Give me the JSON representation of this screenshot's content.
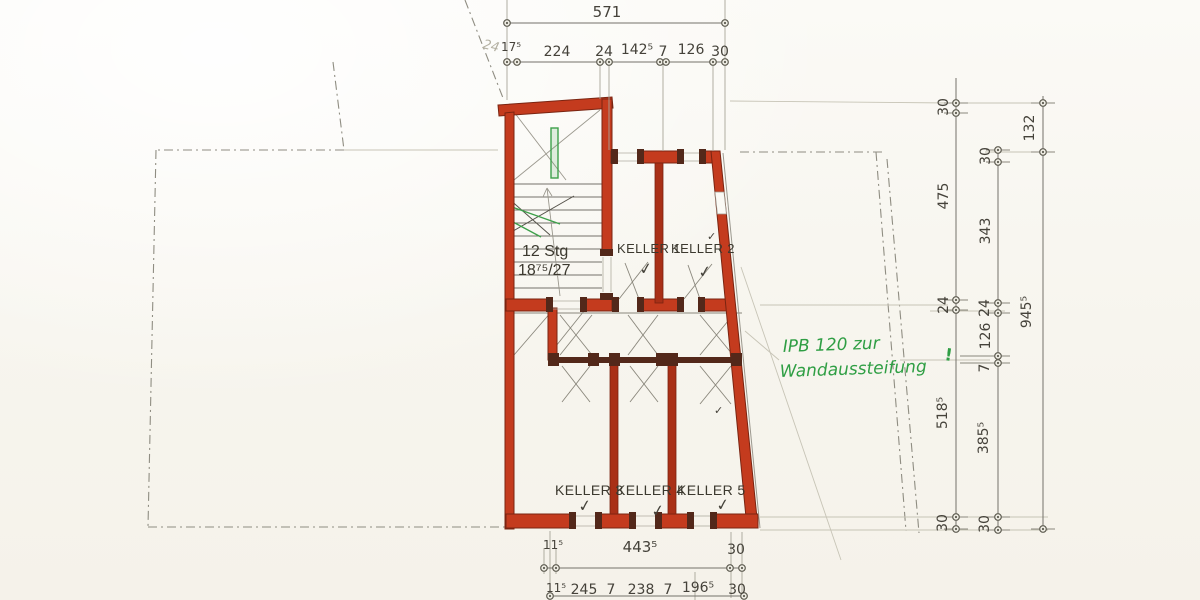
{
  "document": {
    "kind": "scanned hand-drawn basement floor plan (Kellergeschoss)",
    "language": "German"
  },
  "rooms": {
    "stair": {
      "line1": "12 Stg",
      "line2": "18⁷⁵/27"
    },
    "k1": "KELLER 1",
    "k2": "KELLER 2",
    "k3": "KELLER 3",
    "k4": "KELLER 4",
    "k5": "KELLER 5"
  },
  "note": {
    "line1": "IPB 120 zur",
    "line2": "Wandaussteifung",
    "mark": "!"
  },
  "annotations": {
    "corner": "24"
  },
  "symbols": {
    "check": "✓"
  },
  "dims": {
    "top_overall": "571",
    "top_chain": [
      "17⁵",
      "224",
      "24",
      "142⁵",
      "7",
      "126",
      "30"
    ],
    "right_outer": [
      "30",
      "475",
      "24",
      "518⁵",
      "30"
    ],
    "right_inner": [
      "30",
      "343",
      "24",
      "126",
      "7",
      "385⁵",
      "30"
    ],
    "right_far": [
      "132",
      "945⁵"
    ],
    "bottom_row1": [
      "11⁵",
      "443⁵",
      "30"
    ],
    "bottom_row2": [
      "11⁵",
      "245",
      "7",
      "238",
      "7",
      "196⁵",
      "30"
    ]
  },
  "colors": {
    "wall_fill": "#c43b1e",
    "wall_edge": "#7a2411",
    "partition": "#a93017",
    "timber_dark": "#53281a",
    "ink": "#45423a",
    "thin_line": "#74716a",
    "faint_line": "#c2bfb2",
    "boundary": "#8f8d82",
    "green": "#2f9e44",
    "paper": "#f8f6f0"
  }
}
